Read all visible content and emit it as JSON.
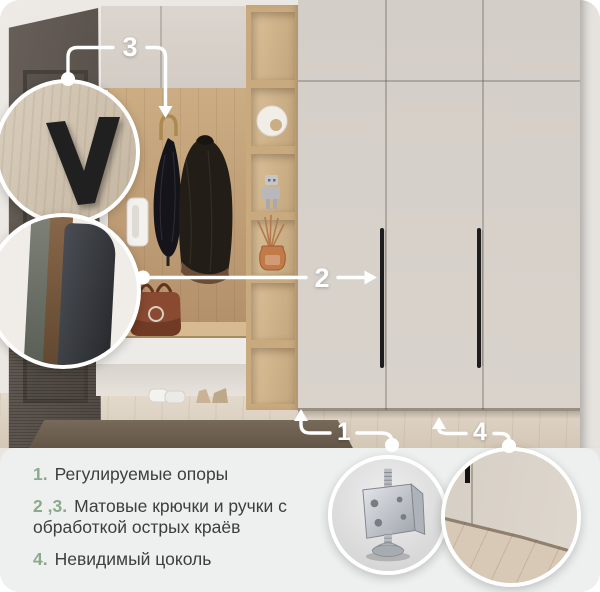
{
  "callouts": {
    "c1": "1",
    "c2": "2",
    "c3": "3",
    "c4": "4"
  },
  "features": {
    "items": [
      {
        "num": "1.",
        "text": "Регулируемые опоры"
      },
      {
        "num": "2 ,3.",
        "text": "Матовые крючки и ручки с обработкой острых краёв"
      },
      {
        "num": "4.",
        "text": "Невидимый цоколь"
      }
    ]
  },
  "insets": {
    "hook_closeup": "matte-black-hook",
    "handle_closeup": "matte-handle-edge",
    "caster_closeup": "adjustable-support-foot",
    "plinth_closeup": "invisible-plinth"
  },
  "colors": {
    "accent_green": "#8BA98B",
    "text": "#3E3E3E",
    "panel_bg": "#EDF0EF",
    "callout": "#FFFFFF"
  }
}
